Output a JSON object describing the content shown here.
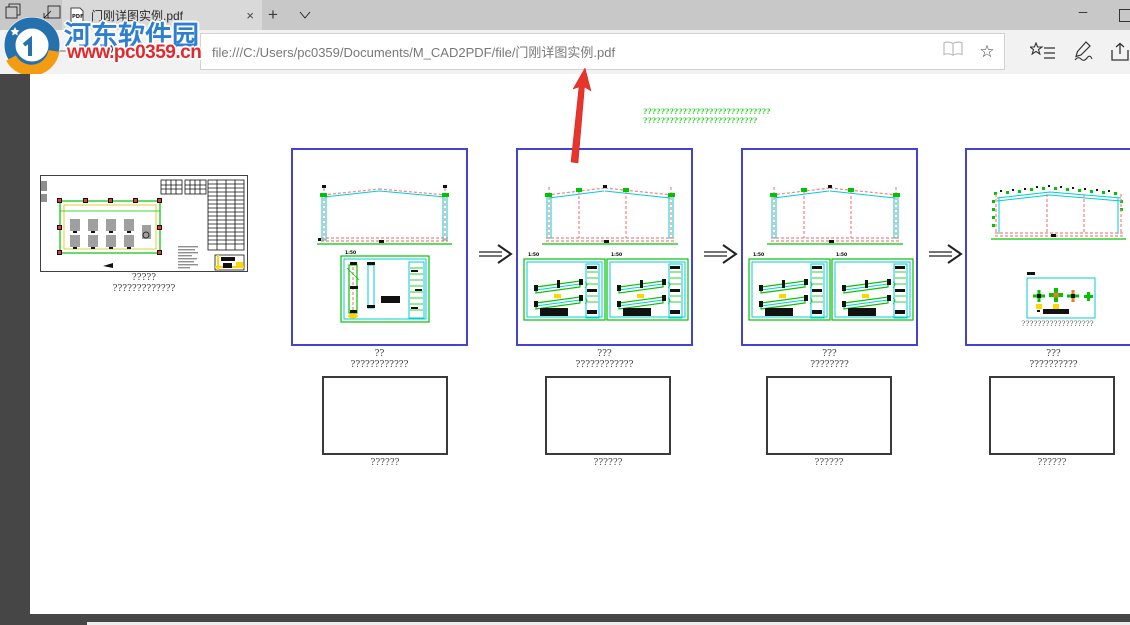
{
  "browser": {
    "tab": {
      "title": "门刚详图实例.pdf",
      "pdf_badge": "PDF"
    },
    "icons": {
      "close": "×",
      "new_tab": "+",
      "refresh": "↻",
      "home": "⌂",
      "favorite": "☆",
      "minimize": "─"
    },
    "address_bar": {
      "url": "file:///C:/Users/pc0359/Documents/M_CAD2PDF/file/门刚详图实例.pdf"
    }
  },
  "watermark": {
    "name": "河东软件园",
    "site": "www.pc0359.cn"
  },
  "document": {
    "header_lines": [
      "?????????????????????????????",
      "??????????????????????????"
    ],
    "panels": [
      {
        "id": "plan-sheet",
        "caption_line1": "?????",
        "caption_line2": "?????????????"
      },
      {
        "id": "stage-1",
        "scale_label": "1:50",
        "caption_line1": "??",
        "caption_line2": "????????????"
      },
      {
        "id": "stage-2",
        "scale_labels": [
          "1:50",
          "1:50"
        ],
        "caption_line1": "???",
        "caption_line2": "????????????"
      },
      {
        "id": "stage-3",
        "scale_labels": [
          "1:50",
          "1:50"
        ],
        "caption_line1": "???",
        "caption_line2": "????????"
      },
      {
        "id": "stage-4",
        "caption_line1": "???",
        "caption_line2": "??????????",
        "note": "??????????????????"
      }
    ],
    "empty_boxes": [
      {
        "caption": "??????"
      },
      {
        "caption": "??????"
      },
      {
        "caption": "??????"
      },
      {
        "caption": "??????"
      }
    ]
  },
  "colors": {
    "panel_border": "#4343cf",
    "cad_green": "#00c400",
    "cad_cyan": "#00ced6",
    "cad_red_dash": "#ef8585",
    "cad_red": "#e53935",
    "cad_yellow": "#ffd600",
    "annotation_arrow": "#e8352b",
    "header_text": "#2ed52e",
    "viewer_bg": "#464646",
    "watermark_blue": "#2f7fd0",
    "watermark_red": "#e8262b"
  }
}
